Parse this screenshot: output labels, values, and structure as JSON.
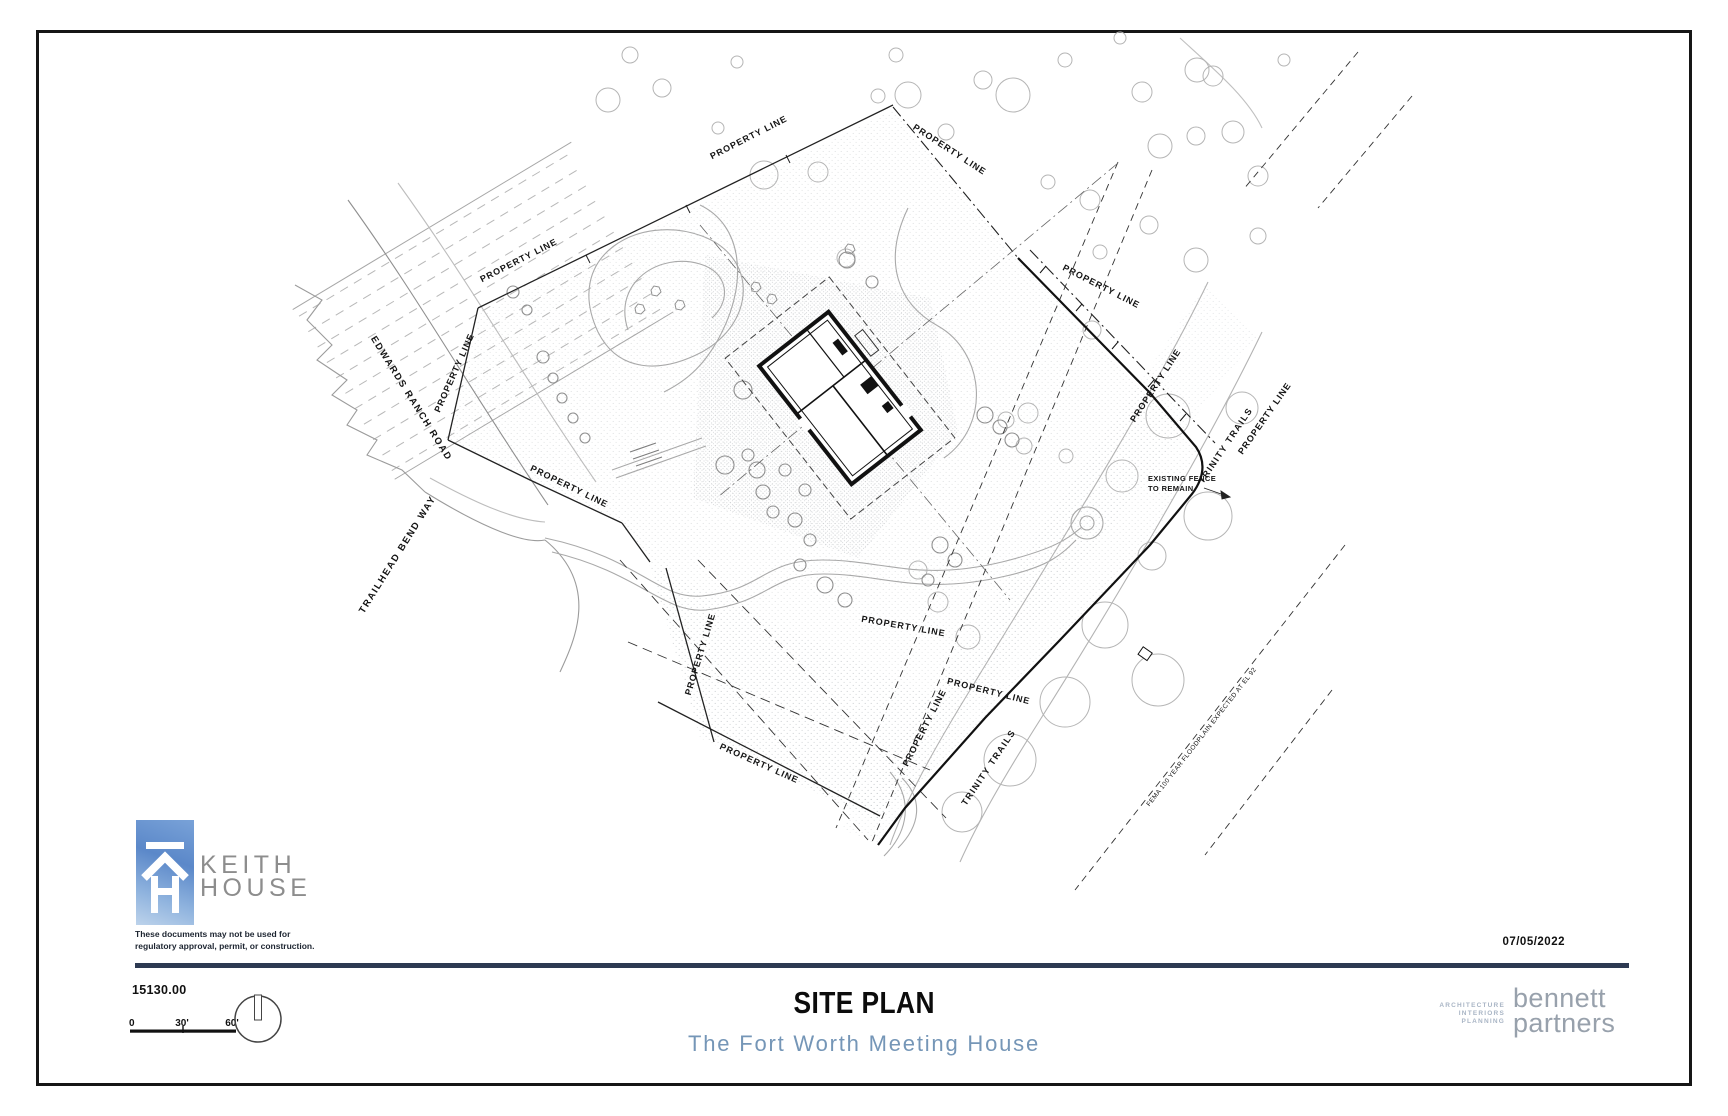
{
  "sheet": {
    "title": "SITE PLAN",
    "subtitle": "The Fort Worth Meeting House",
    "date": "07/05/2022",
    "project_number": "15130.00",
    "disclaimer": [
      "These documents may not be used for",
      "regulatory approval, permit, or construction."
    ],
    "scale_bar": {
      "ticks": [
        "0",
        "30'",
        "60'"
      ]
    }
  },
  "branding": {
    "keith_house": {
      "name_lines": [
        "KEITH",
        "HOUSE"
      ]
    },
    "bennett_partners": {
      "services": [
        "ARCHITECTURE",
        "INTERIORS",
        "PLANNING"
      ],
      "name_lines": [
        "bennett",
        "partners"
      ]
    }
  },
  "colors": {
    "rule_navy": "#2d3a52",
    "subtitle_blue": "#7596b7",
    "logo_sky_blue": "#5b88c9",
    "keith_gray": "#8d8d8d",
    "bennett_gray": "#98a1ac",
    "services_blue": "#a9b5c5"
  },
  "plan": {
    "labels": [
      {
        "text": "PROPERTY LINE",
        "x": 750,
        "y": 140,
        "angle": -27
      },
      {
        "text": "PROPERTY LINE",
        "x": 948,
        "y": 152,
        "angle": 33
      },
      {
        "text": "PROPERTY LINE",
        "x": 520,
        "y": 263,
        "angle": -27
      },
      {
        "text": "PROPERTY LINE",
        "x": 457,
        "y": 374,
        "angle": -66
      },
      {
        "text": "PROPERTY LINE",
        "x": 568,
        "y": 489,
        "angle": 26
      },
      {
        "text": "PROPERTY LINE",
        "x": 703,
        "y": 655,
        "angle": -73
      },
      {
        "text": "PROPERTY LINE",
        "x": 903,
        "y": 629,
        "angle": 10
      },
      {
        "text": "PROPERTY LINE",
        "x": 988,
        "y": 694,
        "angle": 14
      },
      {
        "text": "PROPERTY LINE",
        "x": 927,
        "y": 729,
        "angle": -63
      },
      {
        "text": "PROPERTY LINE",
        "x": 758,
        "y": 766,
        "angle": 24
      },
      {
        "text": "PROPERTY LINE",
        "x": 1100,
        "y": 289,
        "angle": 27
      },
      {
        "text": "PROPERTY LINE",
        "x": 1158,
        "y": 387,
        "angle": -57
      },
      {
        "text": "PROPERTY LINE",
        "x": 1267,
        "y": 420,
        "angle": -55
      },
      {
        "text": "EDWARDS RANCH ROAD",
        "x": 409,
        "y": 400,
        "angle": 58,
        "size": 9.5,
        "spacing": 1.6
      },
      {
        "text": "TRAILHEAD BEND WAY",
        "x": 400,
        "y": 556,
        "angle": -58,
        "size": 9.5,
        "spacing": 1.6
      },
      {
        "text": "TRINITY TRAILS",
        "x": 1228,
        "y": 447,
        "angle": -56,
        "size": 9,
        "spacing": 1.4
      },
      {
        "text": "TRINITY TRAILS",
        "x": 991,
        "y": 769,
        "angle": -56,
        "size": 9,
        "spacing": 1.4
      },
      {
        "text": "FEMA 100 YEAR FLOODPLAIN EXPECTED AT EL 92",
        "x": 1203,
        "y": 738,
        "angle": -52,
        "size": 6.5,
        "weight": 400,
        "spacing": 0.4
      },
      {
        "text": "EXISTING FENCE",
        "x": 1148,
        "y": 481,
        "angle": 0,
        "size": 7.5,
        "anchor": "start",
        "spacing": 0.4
      },
      {
        "text": "TO REMAIN.",
        "x": 1148,
        "y": 491,
        "angle": 0,
        "size": 7.5,
        "anchor": "start",
        "spacing": 0.4
      }
    ]
  }
}
